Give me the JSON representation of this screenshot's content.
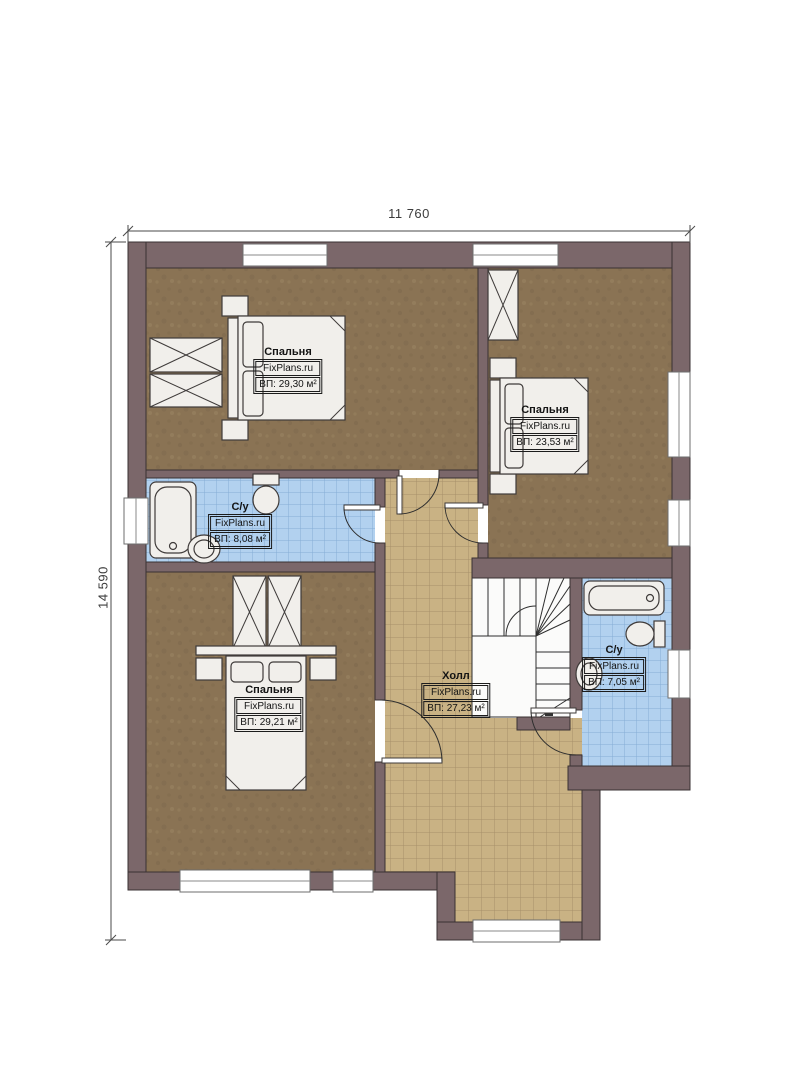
{
  "dimensions": {
    "top": "11 760",
    "left": "14 590"
  },
  "watermark": "FixPlans.ru",
  "rooms": [
    {
      "key": "bedroom-1",
      "name": "Спальня",
      "brand": "FixPlans.ru",
      "area": "ВП: 29,30 м²"
    },
    {
      "key": "bedroom-2",
      "name": "Спальня",
      "brand": "FixPlans.ru",
      "area": "ВП: 23,53 м²"
    },
    {
      "key": "bathroom-1",
      "name": "С/у",
      "brand": "FixPlans.ru",
      "area": "ВП: 8,08 м²"
    },
    {
      "key": "bedroom-3",
      "name": "Спальня",
      "brand": "FixPlans.ru",
      "area": "ВП: 29,21 м²"
    },
    {
      "key": "hall",
      "name": "Холл",
      "brand": "FixPlans.ru",
      "area": "ВП: 27,23 м²"
    },
    {
      "key": "bathroom-2",
      "name": "С/у",
      "brand": "FixPlans.ru",
      "area": "ВП: 7,05 м²"
    }
  ],
  "colors": {
    "wall": "#7b676a",
    "outline": "#3a3233",
    "bedroom_floor": "#8a7354",
    "hall_tile": "#c9b284",
    "bath_tile": "#b2d1ef"
  }
}
